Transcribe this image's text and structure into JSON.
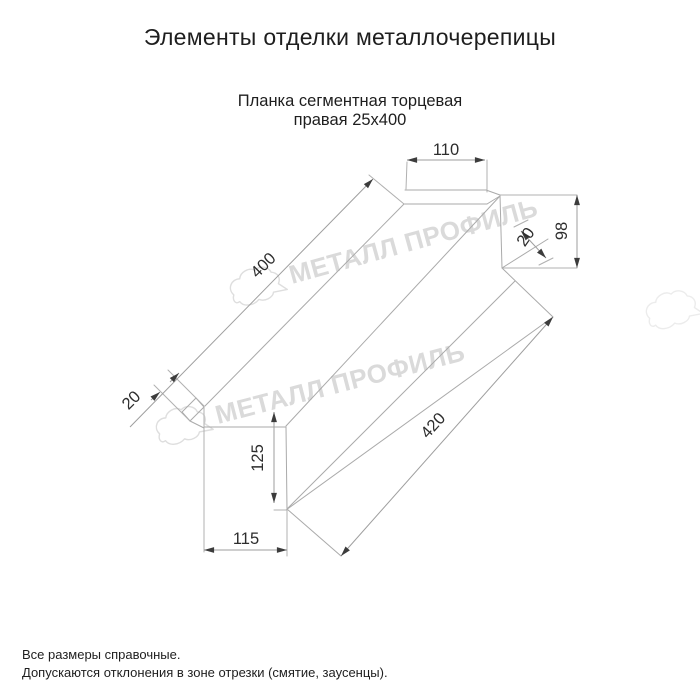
{
  "title": "Элементы отделки металлочерепицы",
  "subtitle": {
    "line1": "Планка сегментная торцевая",
    "line2": "правая 25х400"
  },
  "dimensions": {
    "top_flat_width": "110",
    "end_cap_height": "98",
    "end_cap_fold": "20",
    "top_edge_length": "400",
    "bottom_edge_length": "420",
    "bottom_end_fold": "20",
    "end_face_height": "125",
    "end_face_width": "115"
  },
  "watermark": {
    "text": "МЕТАЛЛ ПРОФИЛЬ"
  },
  "notes": {
    "line1": "Все размеры справочные.",
    "line2": "Допускаются отклонения в зоне отрезки (смятие, заусенцы)."
  },
  "colors": {
    "background": "#ffffff",
    "drawing_line": "#aaaaaa",
    "dimension_text": "#2d2d2d",
    "arrow": "#3c3c3c",
    "watermark": "#dadada",
    "text": "#1e1e1e"
  }
}
